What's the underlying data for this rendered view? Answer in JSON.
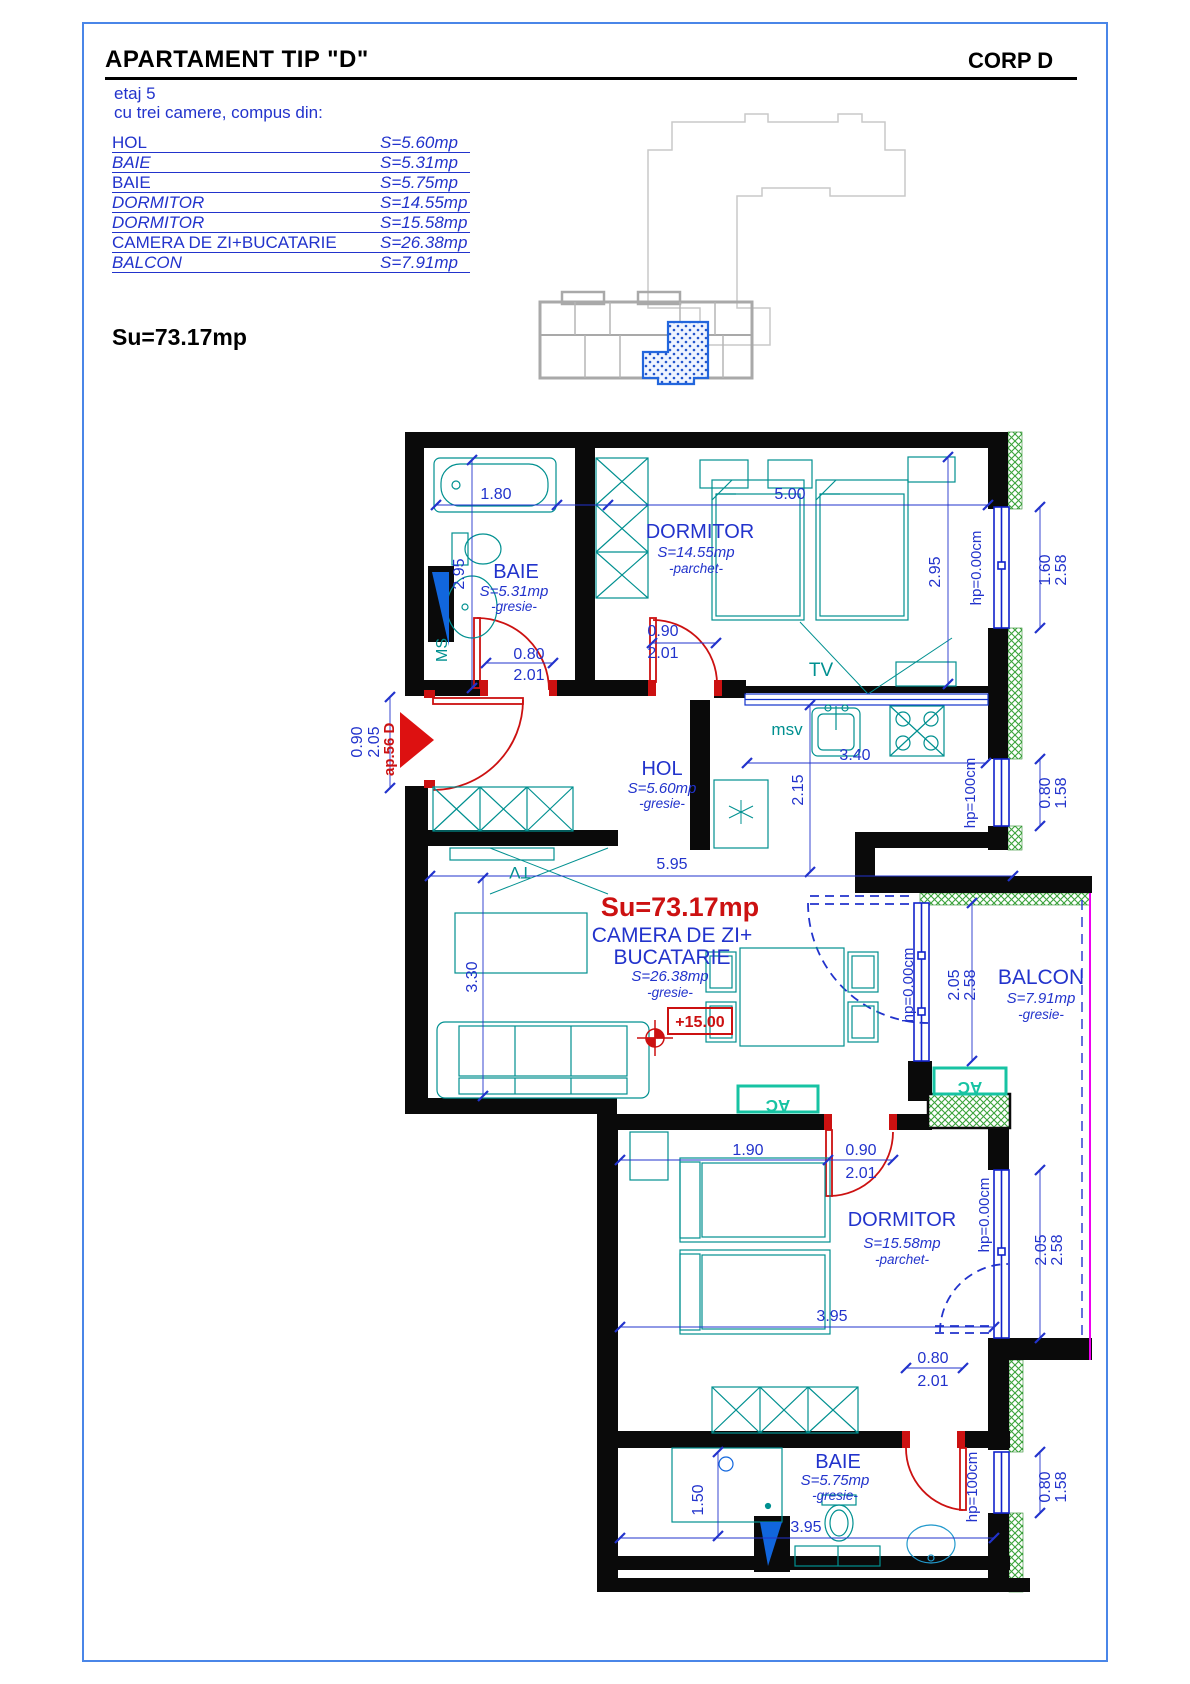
{
  "header": {
    "title": "APARTAMENT TIP \"D\"",
    "corp": "CORP D",
    "floor": "etaj 5",
    "description": "cu trei camere, compus din:"
  },
  "room_list": [
    {
      "name": "HOL",
      "area": "S=5.60mp"
    },
    {
      "name": "BAIE",
      "area": "S=5.31mp"
    },
    {
      "name": "BAIE",
      "area": "S=5.75mp"
    },
    {
      "name": "DORMITOR",
      "area": "S=14.55mp"
    },
    {
      "name": "DORMITOR",
      "area": "S=15.58mp"
    },
    {
      "name": "CAMERA DE ZI+BUCATARIE",
      "area": "S=26.38mp"
    },
    {
      "name": "BALCON",
      "area": "S=7.91mp"
    }
  ],
  "total_area_label": "Su=73.17mp",
  "plan": {
    "su_label": "Su=73.17mp",
    "entry_label": "ap.56 D",
    "level_label": "+15.00",
    "rooms": {
      "baie1": {
        "name": "BAIE",
        "area": "S=5.31mp",
        "finish": "-gresie-"
      },
      "dormitor1": {
        "name": "DORMITOR",
        "area": "S=14.55mp",
        "finish": "-parchet-"
      },
      "hol": {
        "name": "HOL",
        "area": "S=5.60mp",
        "finish": "-gresie-"
      },
      "living": {
        "name": "CAMERA DE ZI+",
        "name2": "BUCATARIE",
        "area": "S=26.38mp",
        "finish": "-gresie-"
      },
      "balcon": {
        "name": "BALCON",
        "area": "S=7.91mp",
        "finish": "-gresie-"
      },
      "dormitor2": {
        "name": "DORMITOR",
        "area": "S=15.58mp",
        "finish": "-parchet-"
      },
      "baie2": {
        "name": "BAIE",
        "area": "S=5.75mp",
        "finish": "-gresie-"
      }
    },
    "fixtures": {
      "ms": "MS",
      "msv": "msv",
      "tv": "TV",
      "ac": "AC"
    },
    "dims": {
      "d180": "1.80",
      "d500": "5.00",
      "d295": "2.95",
      "d090": "0.90",
      "d201": "2.01",
      "d080": "0.80",
      "d205": "2.05",
      "d340": "3.40",
      "d215": "2.15",
      "d595": "5.95",
      "d330": "3.30",
      "d190": "1.90",
      "d395": "3.95",
      "d150": "1.50",
      "d160": "1.60",
      "d258": "2.58",
      "d158": "1.58",
      "hp0": "hp=0.00cm",
      "hp100": "hp=100cm"
    }
  },
  "colors": {
    "accent_blue": "#2233cc",
    "red": "#cc1111",
    "teal": "#009090",
    "hatch_green": "#3aa33a",
    "magenta": "#ee00ee",
    "window_blue": "#1122cc",
    "frame_blue": "#4a86e8",
    "keyplan_unit_blue": "#2266dd"
  }
}
